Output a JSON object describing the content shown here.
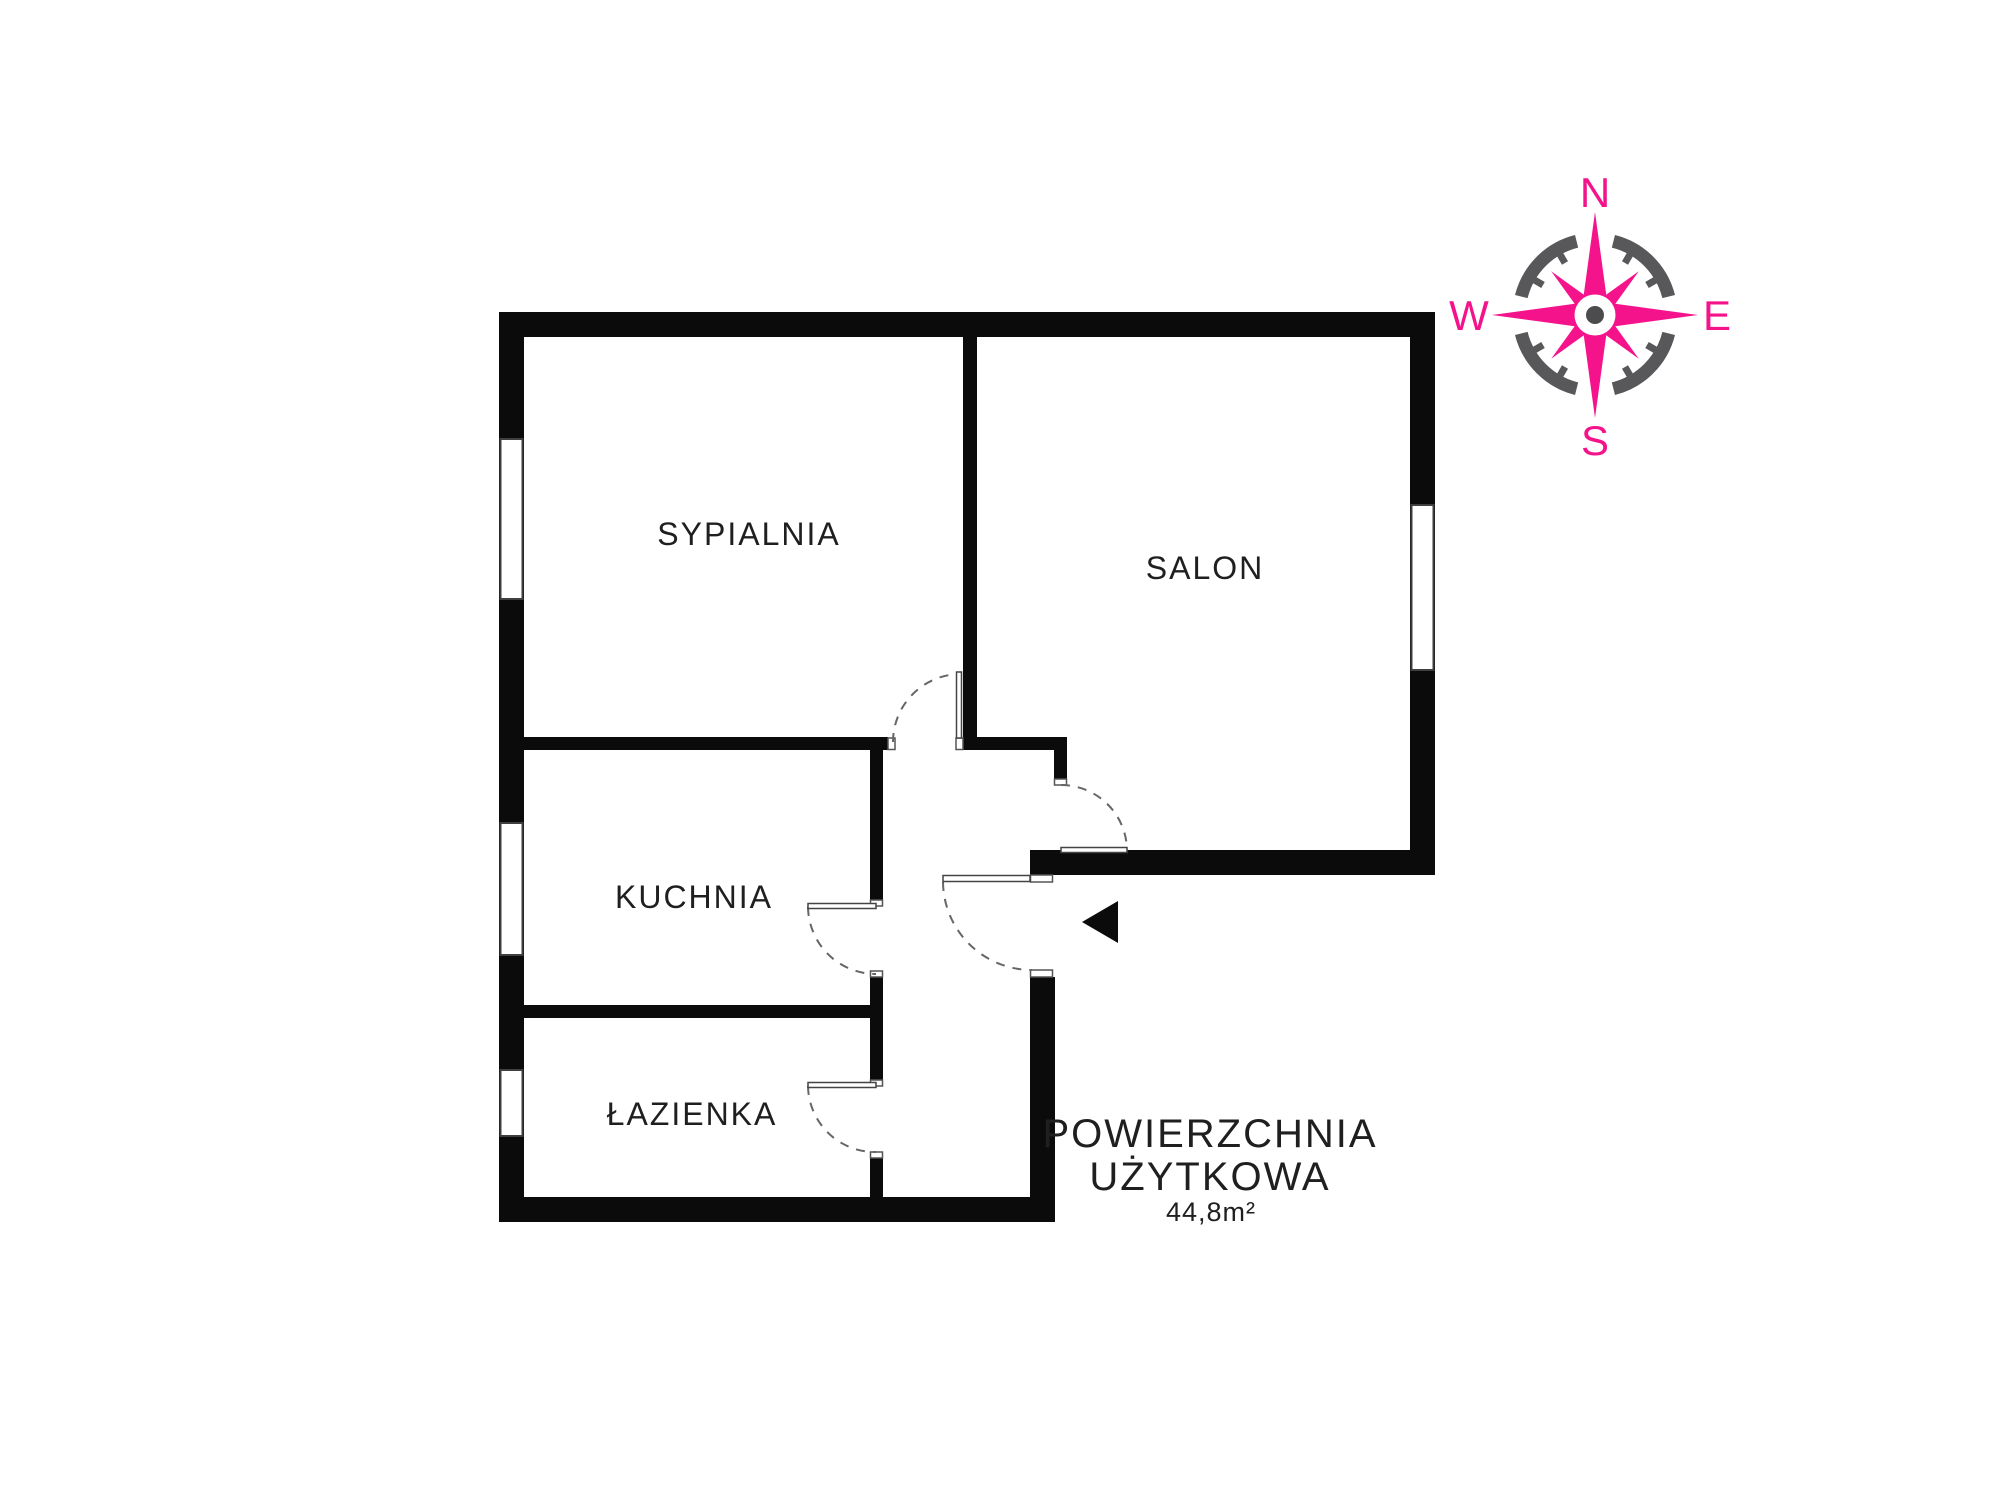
{
  "floor_plan": {
    "rooms": [
      {
        "name": "sypialnia",
        "label": "SYPIALNIA"
      },
      {
        "name": "salon",
        "label": "SALON"
      },
      {
        "name": "kuchnia",
        "label": "KUCHNIA"
      },
      {
        "name": "lazienka",
        "label": "ŁAZIENKA"
      }
    ],
    "area": {
      "title_line1": "POWIERZCHNIA",
      "title_line2": "UŻYTKOWA",
      "value": "44,8m²"
    }
  },
  "compass": {
    "north": "N",
    "east": "E",
    "south": "S",
    "west": "W"
  },
  "colors": {
    "background": "#ffffff",
    "walls": "#0b0b0b",
    "text": "#1f1f1f",
    "door_arc": "#666666",
    "compass_pink": "#f5138c",
    "compass_ring_gray": "#58585b",
    "compass_hub_gray": "#4c4c4f"
  }
}
